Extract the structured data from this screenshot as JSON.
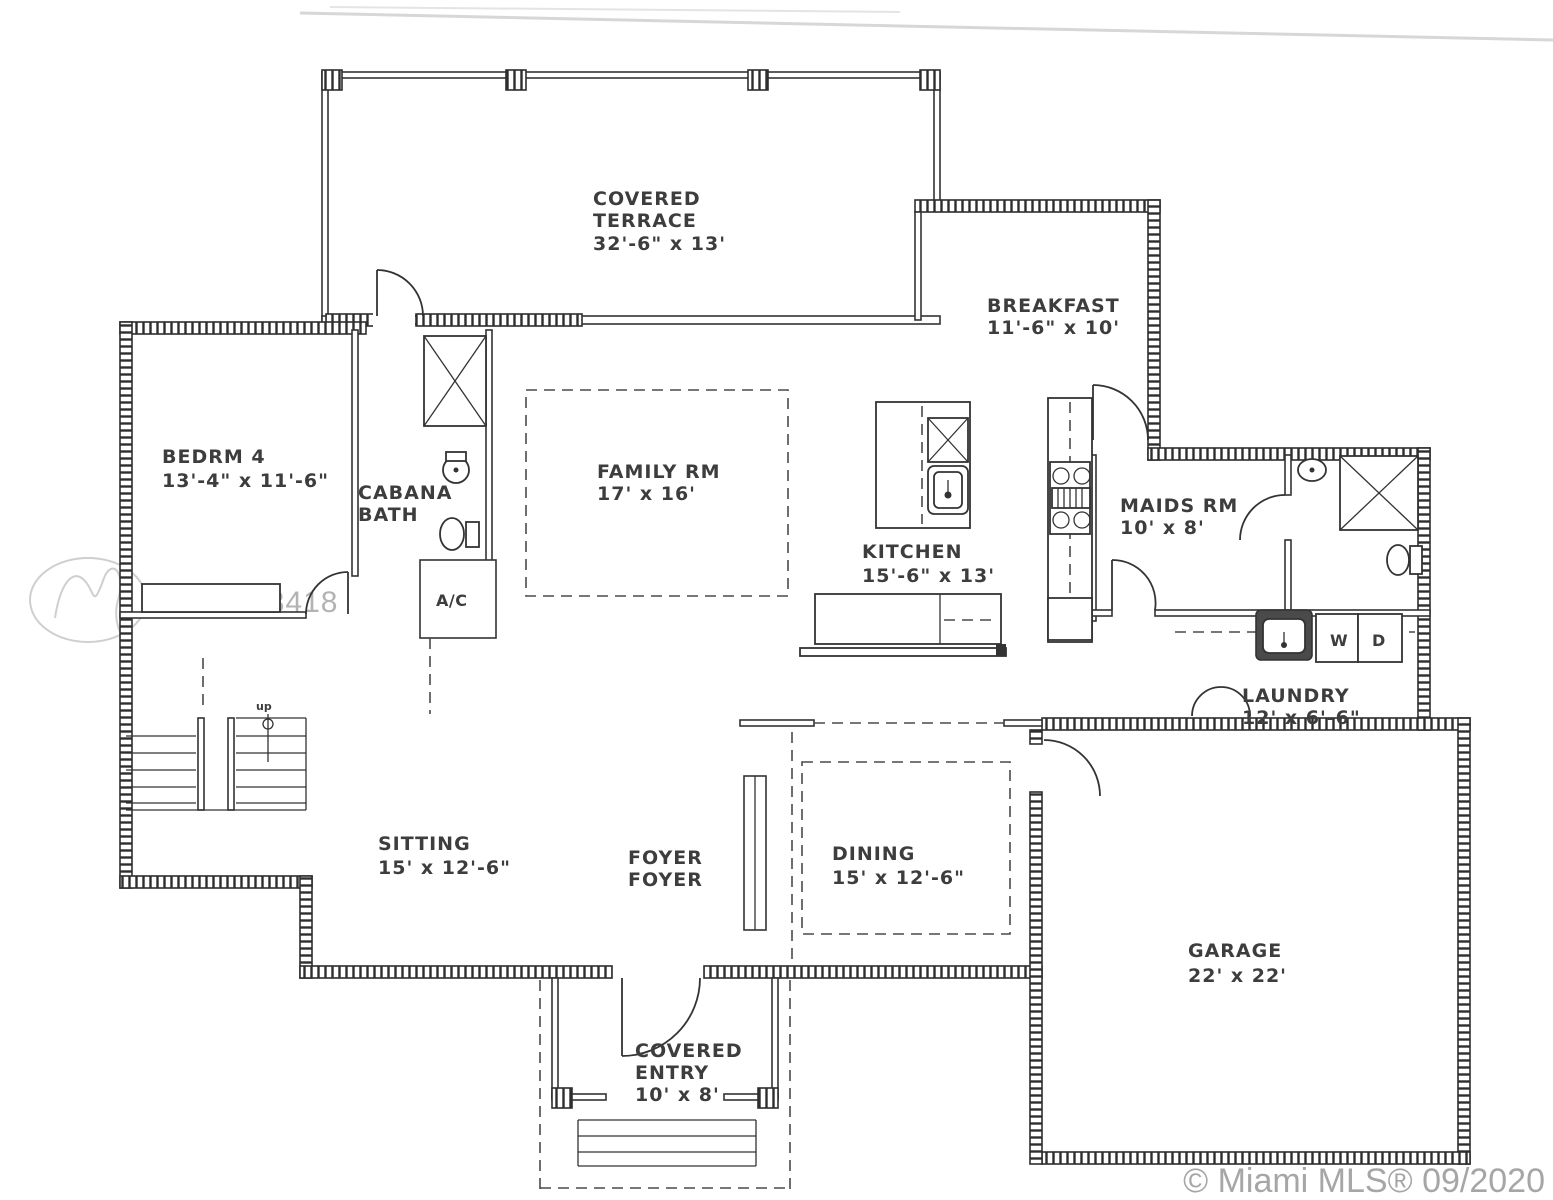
{
  "watermark": {
    "mls_id": "A10923418",
    "footer": "© Miami MLS® 09/2020"
  },
  "rooms": {
    "covered_terrace": {
      "name_line1": "COVERED",
      "name_line2": "TERRACE",
      "dims": "32'-6\" x 13'"
    },
    "breakfast": {
      "name": "BREAKFAST",
      "dims": "11'-6\" x 10'"
    },
    "bedrm4": {
      "name": "BEDRM 4",
      "dims": "13'-4\" x 11'-6\""
    },
    "cabana_bath": {
      "name_line1": "CABANA",
      "name_line2": "BATH"
    },
    "family_rm": {
      "name": "FAMILY RM",
      "dims": "17' x 16'"
    },
    "kitchen": {
      "name": "KITCHEN",
      "dims": "15'-6\" x 13'"
    },
    "maids_rm": {
      "name": "MAIDS RM",
      "dims": "10' x 8'"
    },
    "laundry": {
      "name": "LAUNDRY",
      "dims": "12' x 6'-6\"",
      "washer_label": "W",
      "dryer_label": "D"
    },
    "sitting": {
      "name": "SITTING",
      "dims": "15' x 12'-6\""
    },
    "foyer": {
      "line1": "FOYER",
      "line2": "FOYER"
    },
    "dining": {
      "name": "DINING",
      "dims": "15' x 12'-6\""
    },
    "garage": {
      "name": "GARAGE",
      "dims": "22' x 22'"
    },
    "covered_entry": {
      "name_line1": "COVERED",
      "name_line2": "ENTRY",
      "dims": "10' x 8'"
    },
    "ac_closet": {
      "name": "A/C"
    },
    "stairs": {
      "up_label": "up"
    }
  }
}
